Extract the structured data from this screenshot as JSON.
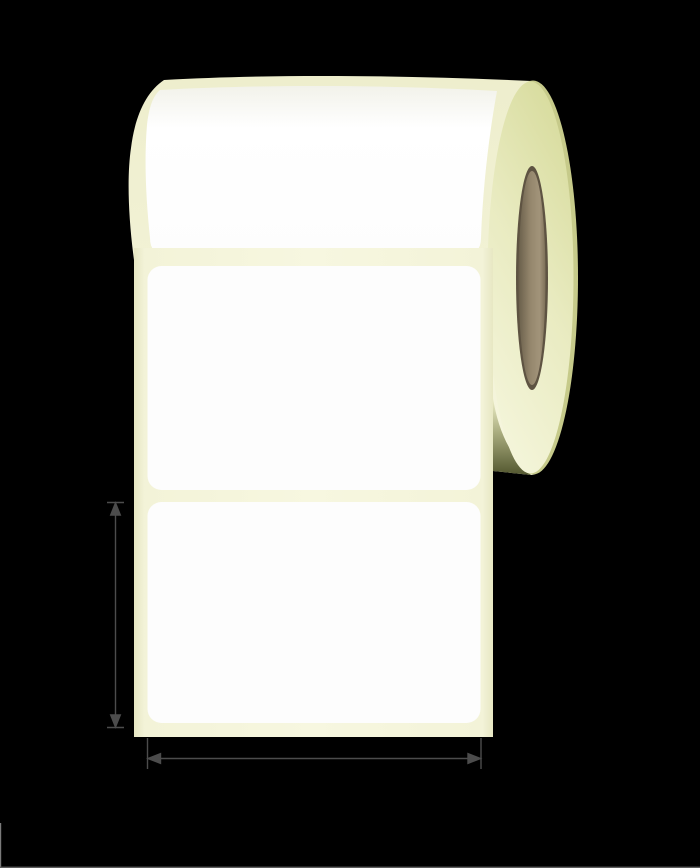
{
  "illustration": {
    "subject": "blank-label-roll",
    "visible_label_count": 3
  },
  "roll": {
    "colors": {
      "label_white": "#fdfdfd",
      "label_white_shade": "#f2f2ea",
      "label_white_bright": "#ffffff",
      "liner_edge": "#e7e7c3",
      "liner_inner": "#f3f3d8",
      "liner_center": "#f7f7e0",
      "body_top": "#eeeecd",
      "body_bottom": "#f6f6de",
      "face_top": "#d7db9c",
      "face_mid": "#e9ebc1",
      "face_bottom": "#f4f5da",
      "face_rim": "#c6ca8a",
      "core_rim": "#5e5342",
      "core_dark": "#6a5f4b",
      "core_mid": "#95876d",
      "core_light": "#a2947a",
      "core_edge": "#7d7058",
      "shadow_light": "#eff0cb",
      "shadow_mid": "#a9ac7e",
      "shadow_dark": "#53572f"
    }
  },
  "dimensions": {
    "arrow_color": "#4c4c4c",
    "height_arrow": "label-height-dimension",
    "width_arrow": "label-width-dimension"
  },
  "artifacts": {
    "left_edge_line": "#7a7a7a",
    "bottom_edge_line": "#5e5e5e"
  }
}
